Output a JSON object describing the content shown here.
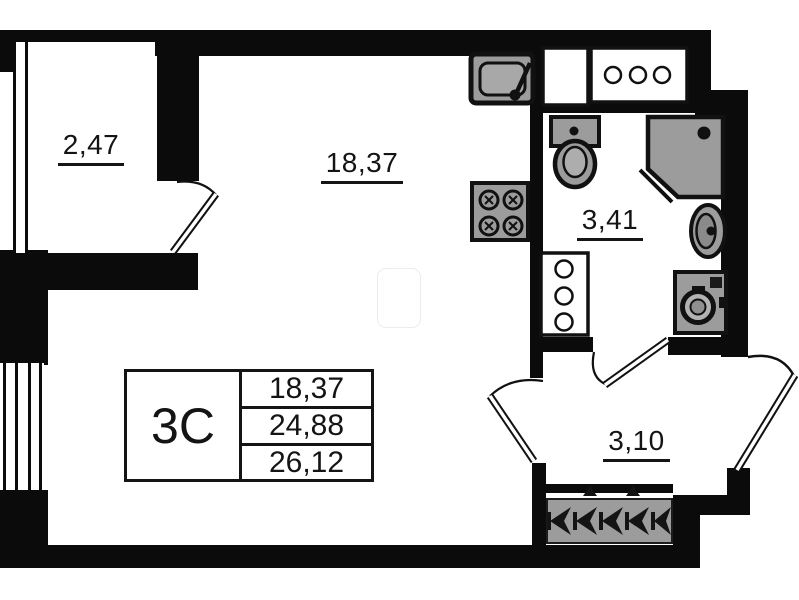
{
  "rooms": [
    {
      "name": "loggia",
      "area_label": "2,47"
    },
    {
      "name": "living-kitchen",
      "area_label": "18,37"
    },
    {
      "name": "bathroom",
      "area_label": "3,41"
    },
    {
      "name": "hallway",
      "area_label": "3,10"
    }
  ],
  "info_table": {
    "type_code": "3С",
    "rows": [
      "18,37",
      "24,88",
      "26,12"
    ]
  },
  "fixtures": [
    "kitchen-sink",
    "cooktop-4-burner",
    "vent-shaft-blank",
    "vent-shaft-3-holes",
    "toilet",
    "corner-shower",
    "washbasin",
    "washing-machine",
    "bathroom-cabinet-3-holes",
    "entrance-mat-arrows"
  ],
  "entrance_arrow_count": 5,
  "colors": {
    "wall": "#0b0b0b",
    "fixture_fill": "#9c9c9c",
    "line": "#141414",
    "background": "#ffffff"
  }
}
